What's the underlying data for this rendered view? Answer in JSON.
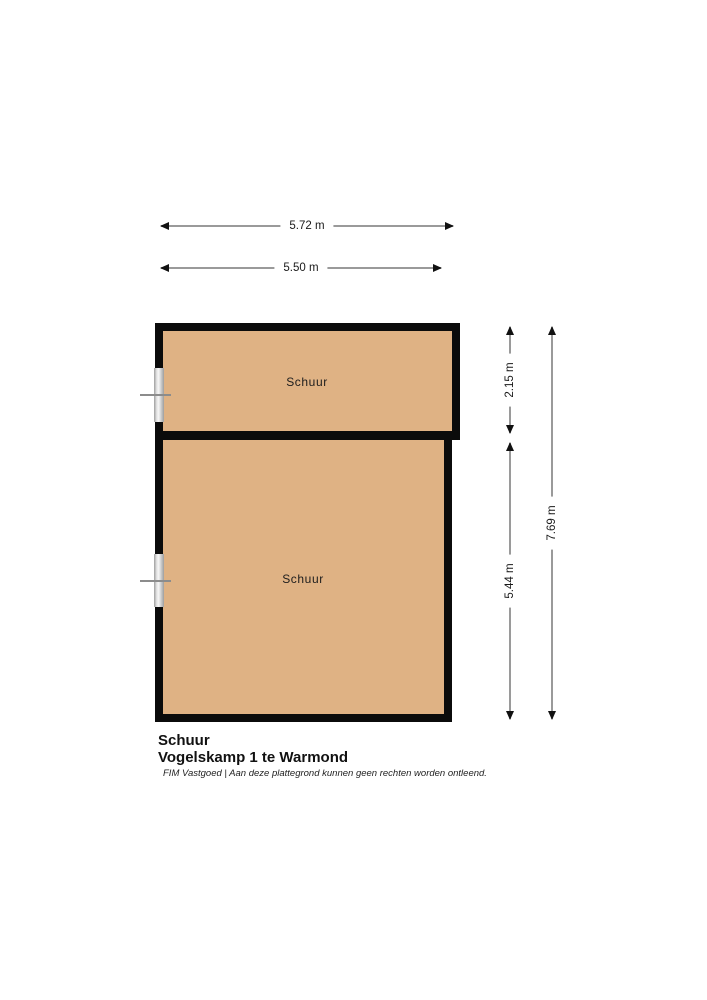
{
  "plan": {
    "rooms": [
      {
        "label": "Schuur"
      },
      {
        "label": "Schuur"
      }
    ],
    "colors": {
      "floor": "#dfb284",
      "wall": "#0b0b0b",
      "dim-line": "#9a9a9a",
      "dim-text": "#1a1a1a",
      "window-frame": "#9e9e9e",
      "window-glass": "#f6f6f6"
    }
  },
  "dimensions": {
    "horizontal": [
      {
        "label": "5.72 m"
      },
      {
        "label": "5.50 m"
      }
    ],
    "vertical": [
      {
        "label": "2.15 m"
      },
      {
        "label": "5.44 m"
      },
      {
        "label": "7.69 m"
      }
    ]
  },
  "footer": {
    "title": "Schuur",
    "subtitle": "Vogelskamp 1 te Warmond",
    "disclaimer": "FIM Vastgoed | Aan deze plattegrond kunnen geen rechten worden ontleend."
  }
}
